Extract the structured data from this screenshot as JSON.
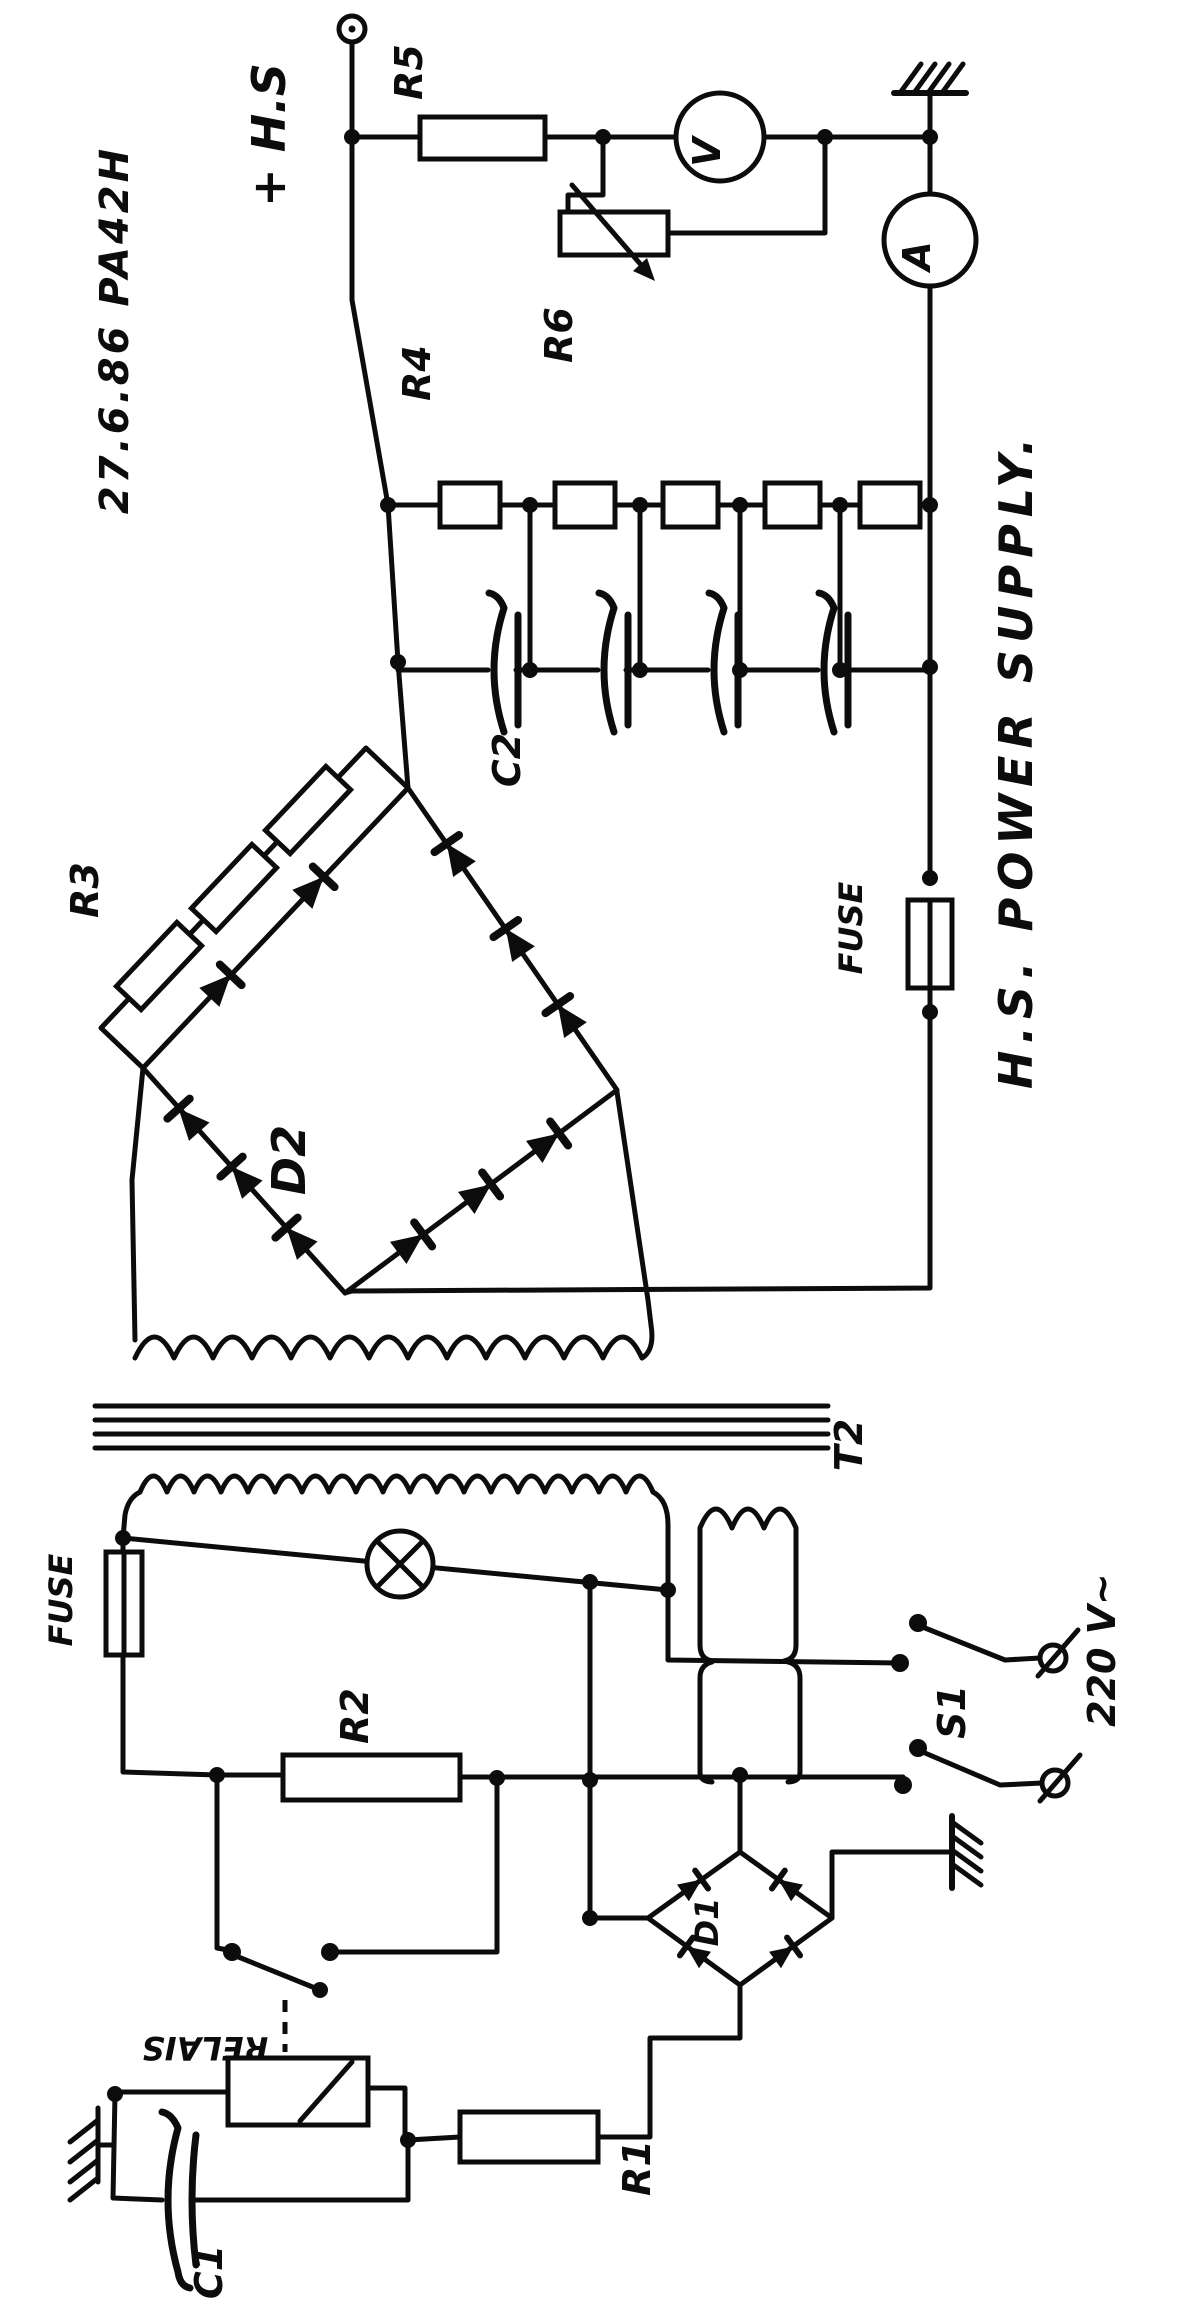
{
  "schematic": {
    "title": "H.S. POWER SUPPLY.",
    "date_ref": "27.6.86  PA42H",
    "output_label": "+ H.S",
    "mains_label": "220 V~",
    "labels": {
      "r1": "R1",
      "r2": "R2",
      "r3": "R3",
      "r4": "R4",
      "r5": "R5",
      "r6": "R6",
      "c1": "C1",
      "c2": "C2",
      "d1": "D1",
      "d2": "D2",
      "t2": "T2",
      "s1": "S1",
      "relay": "RELAIS",
      "fuse_hv": "FUSE",
      "fuse_primary": "FUSE"
    },
    "meters": {
      "voltmeter": "V",
      "ammeter": "A"
    }
  }
}
